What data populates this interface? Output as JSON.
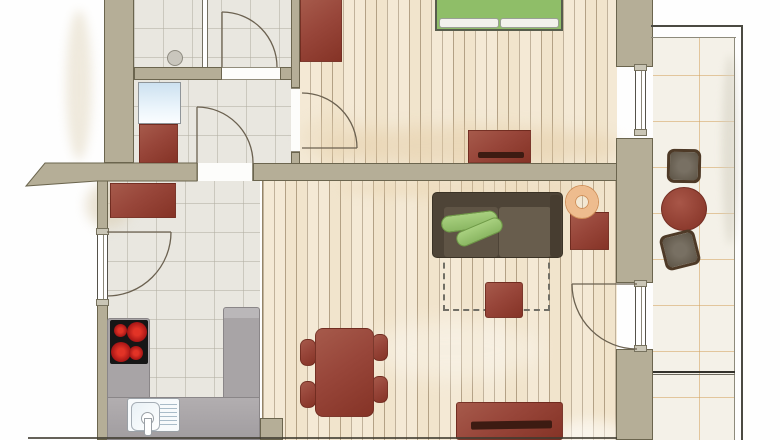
{
  "title": "apartment-floor-plan",
  "visible_text": [],
  "palette": {
    "wall_fill": "#b5ae97",
    "wall_outline": "#6b654e",
    "wood_floor": "#f1e4cc",
    "wood_plank_line": "#765e3e",
    "interior_tile": "#e9e7e0",
    "interior_tile_line": "#b2aea2",
    "balcony_tile": "#f4f1e8",
    "balcony_tile_line": "#d3a15c",
    "furniture_red": "#98463a",
    "furniture_slot_dark": "#3d1b12",
    "sofa_brown": "#4e4437",
    "sofa_seat": "#645949",
    "bed_green": "#8fbe68",
    "cushion_green": "#9cc673",
    "lamp_orange": "#eebc8e",
    "counter_grey": "#a8a4a6",
    "cooktop_black": "#161616",
    "burner_red": "#c61f1f",
    "washer_blue": "#cfe3f2",
    "pillow_white": "#f2f2ec"
  },
  "rooms": [
    {
      "name": "bathroom",
      "floor": "tile",
      "fixtures": [
        "shower-drain",
        "shower-partition",
        "door-swing"
      ]
    },
    {
      "name": "hallway",
      "floor": "tile",
      "furniture": [
        "washing-machine",
        "cabinet"
      ]
    },
    {
      "name": "kitchen",
      "floor": "tile",
      "furniture": [
        "tall-cupboard",
        "u-shaped-counter",
        "cooktop-4-burners",
        "sink-with-drainboard"
      ],
      "fixtures": [
        "window-with-casement-swing",
        "door-swing"
      ]
    },
    {
      "name": "bedroom",
      "floor": "wood-planks",
      "furniture": [
        "double-bed-green",
        "wardrobe",
        "sideboard"
      ],
      "fixtures": [
        "window",
        "door-swing"
      ]
    },
    {
      "name": "living-dining-room",
      "floor": "wood-planks",
      "furniture": [
        "sofa-with-green-cushions",
        "floor-lamp-ring",
        "side-table",
        "pouf",
        "rug-dashed-outline",
        "dining-table",
        "four-chairs",
        "tv-lowboard"
      ],
      "fixtures": [
        "balcony-door-swing"
      ]
    },
    {
      "name": "balcony",
      "floor": "orange-grid-tile",
      "furniture": [
        "chair",
        "round-table",
        "chair-rotated"
      ],
      "fixtures": [
        "railing",
        "divider-line"
      ]
    }
  ],
  "annotations": {
    "doors": 4,
    "windows": 2,
    "balcony_door": 1,
    "style": "watercolor architectural plan, no text labels rendered"
  }
}
